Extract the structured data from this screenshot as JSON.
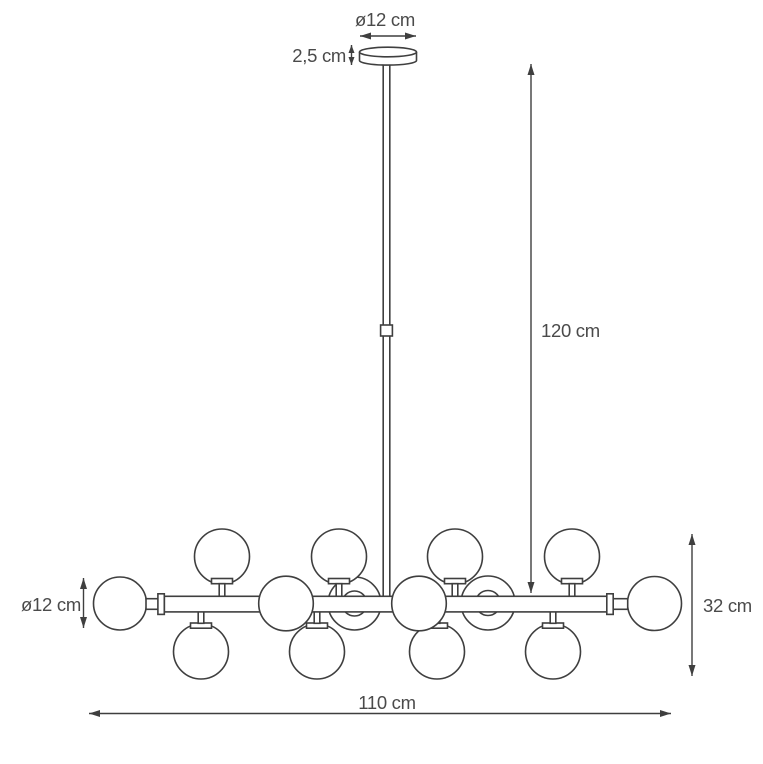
{
  "figure": {
    "labels": {
      "canopy_diameter": "ø12 cm",
      "canopy_height": "2,5 cm",
      "rod_length": "120 cm",
      "sphere_diameter": "ø12 cm",
      "body_height": "32 cm",
      "body_width": "110 cm"
    },
    "colors": {
      "line": "#3f3f3f",
      "label_text": "#4a4a4a",
      "background": "#ffffff"
    },
    "counts": {
      "glass_spheres_total": 14,
      "spheres_top_row": 4,
      "spheres_bottom_row": 4,
      "spheres_bar_ends": 2,
      "spheres_front": 2,
      "spheres_back": 2
    }
  }
}
